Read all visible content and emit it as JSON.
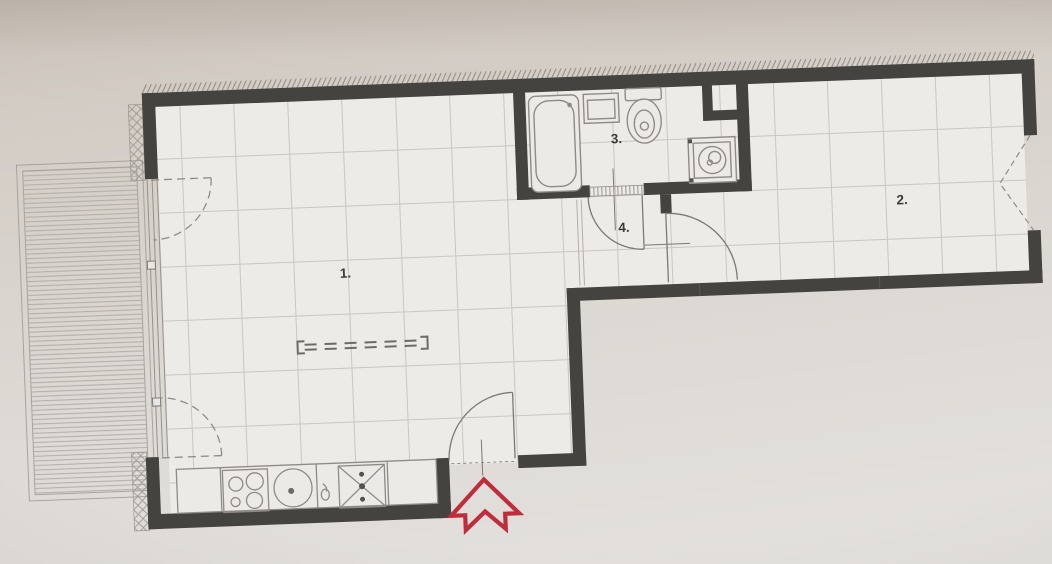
{
  "title": "apartment-floor-plan",
  "rooms": [
    {
      "id": "living-room-kitchen",
      "label": "1."
    },
    {
      "id": "bedroom",
      "label": "2."
    },
    {
      "id": "bathroom",
      "label": "3."
    },
    {
      "id": "hallway",
      "label": "4."
    }
  ],
  "fixtures": [
    "bathtub-icon",
    "washbasin-icon",
    "toilet-icon",
    "washing-machine-icon",
    "cooktop-icon",
    "kitchen-sink-icon",
    "faucet-icon",
    "dishwasher-icon",
    "sideboard-dashed-icon",
    "balcony-deck",
    "entrance-arrow-icon"
  ],
  "colors": {
    "wall": "#45433f",
    "paper": "#d8d2cb",
    "floor": "#edebe7",
    "grid_line": "#cac6c1",
    "fixture_line": "#8f8b85",
    "door_line": "#7d7974",
    "accent_red": "#bf2c3c"
  }
}
